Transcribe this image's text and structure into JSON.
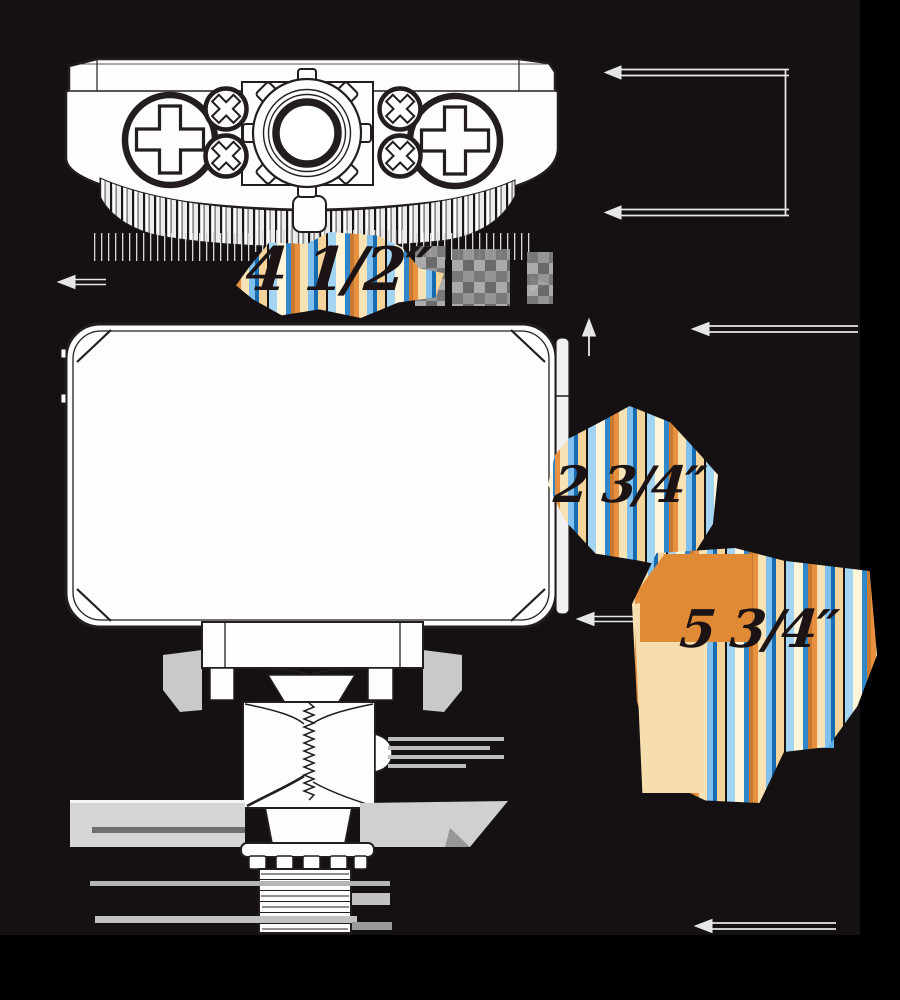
{
  "diagram": {
    "title": "flood-light-dimension-diagram",
    "background_color": "#151112",
    "line_color": "#241d1e",
    "fill_color": "#fdfdfd",
    "glitch_colors": {
      "orange": "#e79140",
      "cream": "#f6e2b4",
      "light_blue": "#7fc0ee",
      "deep_blue": "#176bb0"
    },
    "dimensions": {
      "width": {
        "label": "4 1/2″"
      },
      "body_height": {
        "label": "2 3/4″"
      },
      "overall_height": {
        "label": "5 3/4″"
      }
    }
  }
}
